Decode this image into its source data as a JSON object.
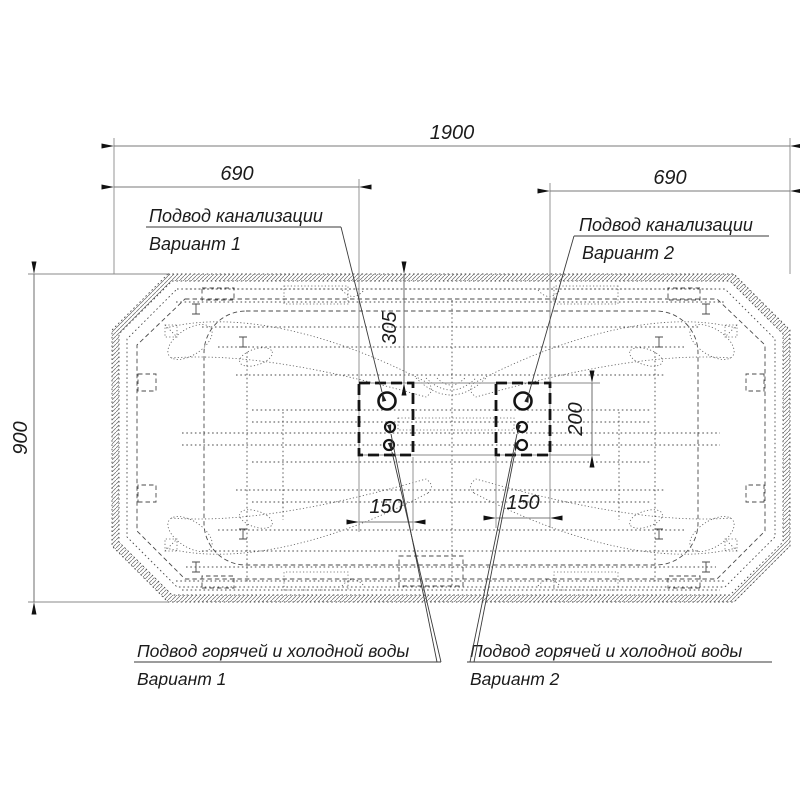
{
  "dimensions": {
    "overall_width": "1900",
    "left_offset": "690",
    "right_offset": "690",
    "depth": "900",
    "sewer_offset_from_edge": "305",
    "connection_zone_height": "200",
    "connection_zone_width_v1": "150",
    "connection_zone_width_v2": "150"
  },
  "callouts": {
    "sewer_v1": {
      "line1": "Подвод канализации",
      "line2": "Вариант 1"
    },
    "sewer_v2": {
      "line1": "Подвод канализации",
      "line2": "Вариант 2"
    },
    "water_v1": {
      "line1": "Подвод горячей и холодной воды",
      "line2": "Вариант 1"
    },
    "water_v2": {
      "line1": "Подвод горячей и холодной воды",
      "line2": "Вариант 2"
    }
  },
  "colors": {
    "background": "#ffffff",
    "main_line": "#1a1a1a",
    "dim_line": "#7a7a7a",
    "text": "#1b1b1b"
  }
}
